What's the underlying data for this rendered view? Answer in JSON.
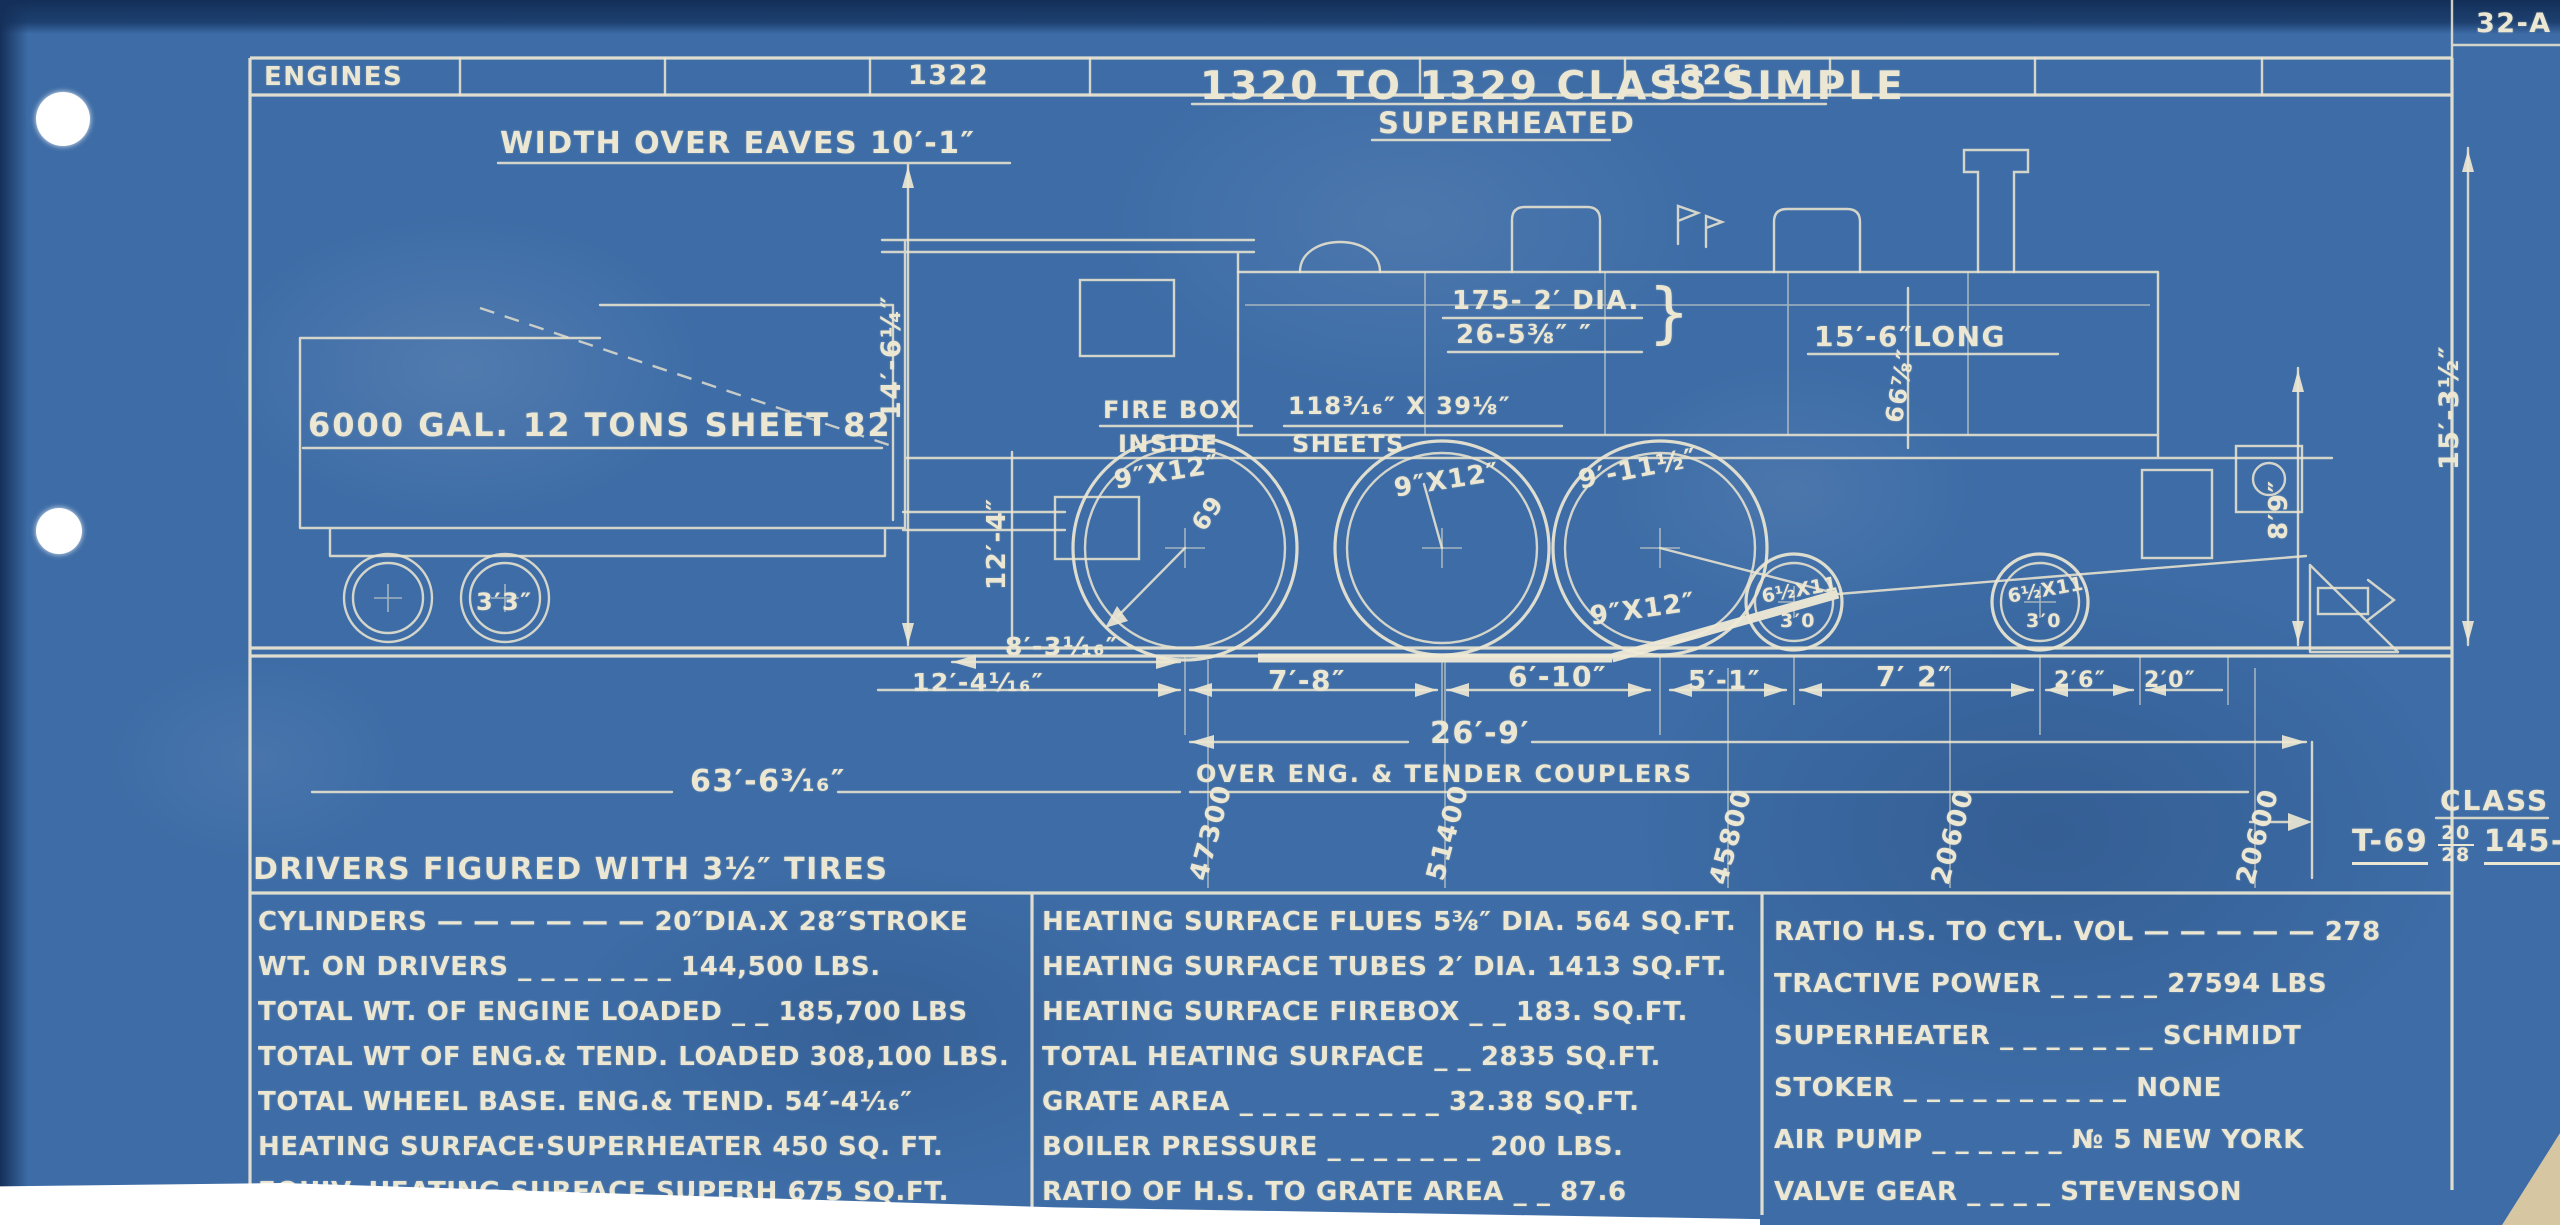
{
  "sheet": {
    "number": "32-A"
  },
  "header": {
    "label": "ENGINES",
    "engine_numbers": [
      "1322",
      "1326"
    ]
  },
  "title": {
    "line1": "1320 TO 1329 CLASS SIMPLE",
    "line2": "SUPERHEATED"
  },
  "labels": {
    "width_over_eaves": "WIDTH OVER EAVES  10′-1″",
    "flues_count": "175- 2′ DIA.",
    "flues_count2": "26-5⅜″ ″",
    "brace": "}",
    "boiler_length": "15′-6″LONG",
    "firebox": "FIRE BOX",
    "inside": "INSIDE",
    "firebox_dims": "118³⁄₁₆″ X 39⅛″",
    "sheets": "SHEETS",
    "tender_note": "6000 GAL.  12 TONS SHEET 82",
    "tender_wheel": "3′3″",
    "journal1": "9″X12″",
    "journal2": "9″X12″",
    "journal3": "9′-11½″",
    "journal4": "9″X12″",
    "driver_dia": "69",
    "truck_journal1": "6½X11",
    "truck_dia1": "3′0",
    "truck_journal2": "6½X11",
    "truck_dia2": "3′0",
    "dim_14_6": "14′-6¼″",
    "dim_12_4v": "12′-4″",
    "dim_66": "66⅞″",
    "dim_8_9": "8′9″",
    "dim_15_3": "15′-3½″",
    "dim_8_3": "8′-3¹⁄₁₆″",
    "dim_12_4": "12′-4¹⁄₁₆″",
    "dim_7_8": "7′-8″",
    "dim_6_10": "6′-10″",
    "dim_5_1": "5′-1″",
    "dim_7_2": "7′ 2″",
    "dim_2_6": "2′6″",
    "dim_2_0": "2′0″",
    "dim_26_9": "26′-9′",
    "dim_63_6": "63′-6³⁄₁₆″",
    "couplers_note": "OVER ENG. & TENDER COUPLERS",
    "weight1": "47300",
    "weight2": "51400",
    "weight3": "45800",
    "weight4": "20600",
    "weight5": "20600",
    "drivers_note": "DRIVERS FIGURED WITH 3½″ TIRES"
  },
  "class_box": {
    "label": "CLASS",
    "prefix": "T-69",
    "frac_top": "20",
    "frac_bottom": "28",
    "suffix": "145-S"
  },
  "spec_table": {
    "left": [
      "CYLINDERS — — — — — —  20″DIA.X 28″STROKE",
      "WT. ON DRIVERS _ _ _ _ _ _ _ 144,500 LBS.",
      "TOTAL WT. OF ENGINE LOADED _ _ 185,700 LBS",
      "TOTAL WT OF ENG.& TEND. LOADED 308,100 LBS.",
      "TOTAL WHEEL BASE. ENG.& TEND.  54′-4¹⁄₁₆″",
      "HEATING SURFACE·SUPERHEATER 450 SQ. FT.",
      "EQUIV. HEATING SURFACE SUPERH  675 SQ.FT."
    ],
    "middle": [
      "HEATING SURFACE FLUES 5⅜″ DIA. 564 SQ.FT.",
      "HEATING SURFACE TUBES 2′ DIA. 1413 SQ.FT.",
      "HEATING SURFACE FIREBOX _ _ 183.  SQ.FT.",
      "TOTAL HEATING SURFACE _ _ 2835 SQ.FT.",
      "GRATE AREA _ _ _ _ _ _ _ _ _ 32.38 SQ.FT.",
      "BOILER PRESSURE _ _ _ _ _ _ _ 200 LBS.",
      "RATIO OF H.S. TO GRATE AREA _ _ 87.6"
    ],
    "right": [
      "RATIO H.S. TO CYL. VOL  — — — — —  278",
      "TRACTIVE POWER _ _ _ _ _  27594 LBS",
      "SUPERHEATER  _ _ _ _ _ _ _ SCHMIDT",
      "STOKER _ _ _ _ _ _ _ _ _ _ NONE",
      "AIR PUMP _ _ _ _ _ _ № 5 NEW YORK",
      "VALVE GEAR  _ _ _ _ STEVENSON"
    ]
  },
  "colors": {
    "paper": "#3d6ca6",
    "ink": "#ece7d2"
  }
}
